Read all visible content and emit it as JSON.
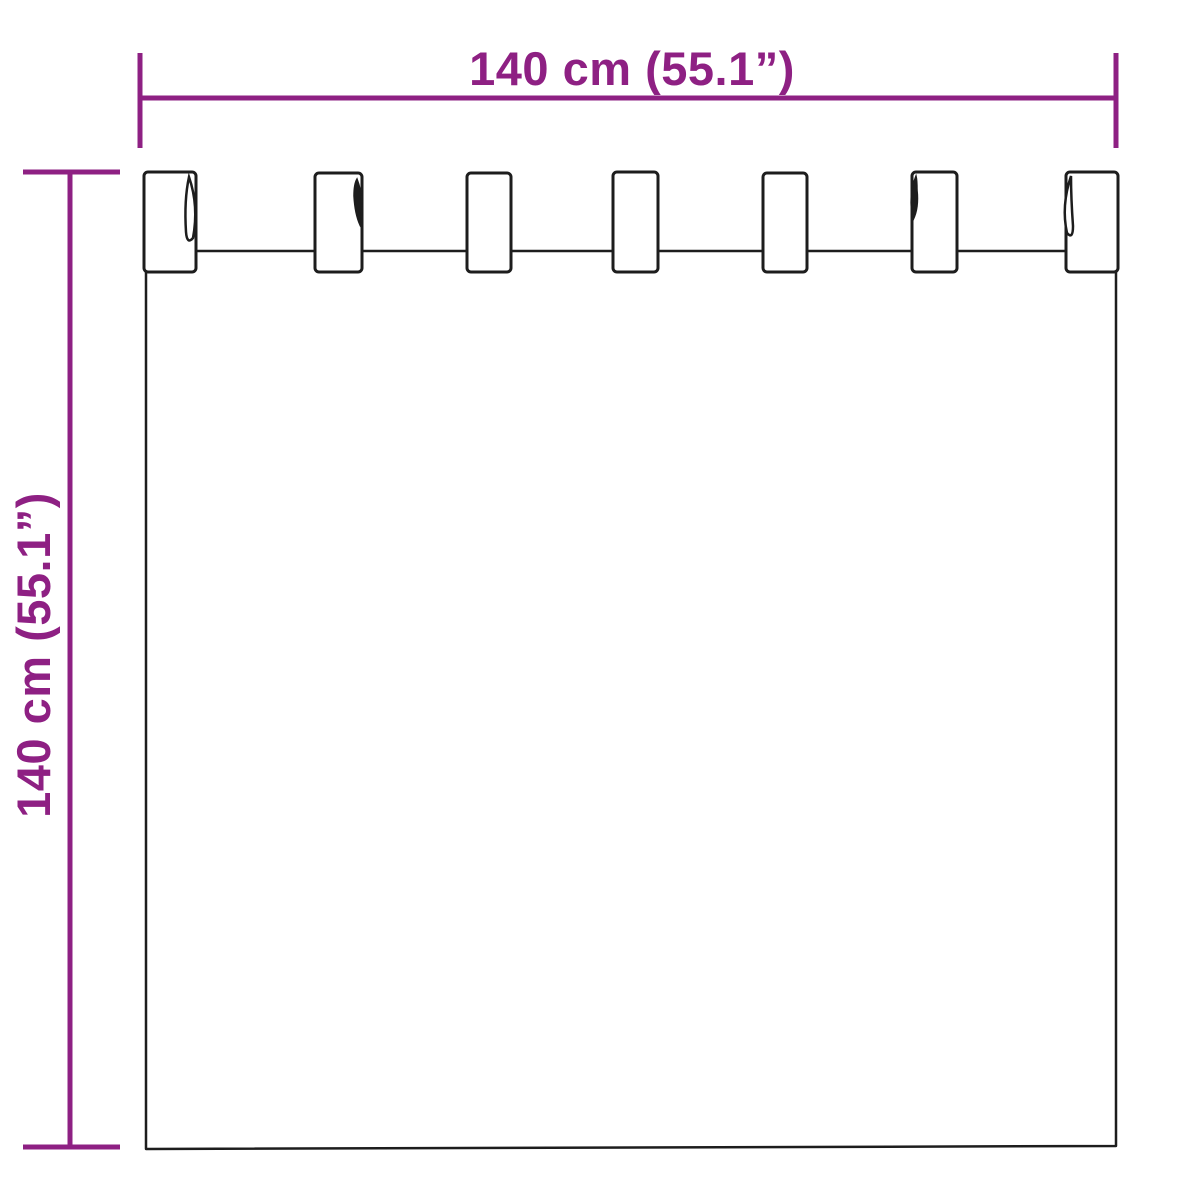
{
  "diagram": {
    "subject": "tab-top-curtain-dimension-drawing",
    "tab_count": 7
  },
  "dimensions": {
    "width": {
      "label": "140 cm (55.1”)"
    },
    "height": {
      "label": "140 cm (55.1”)"
    }
  },
  "colors": {
    "dimension_line": "#8E2083",
    "drawing_outline": "#1D1D1D",
    "background": "#FFFFFF"
  }
}
